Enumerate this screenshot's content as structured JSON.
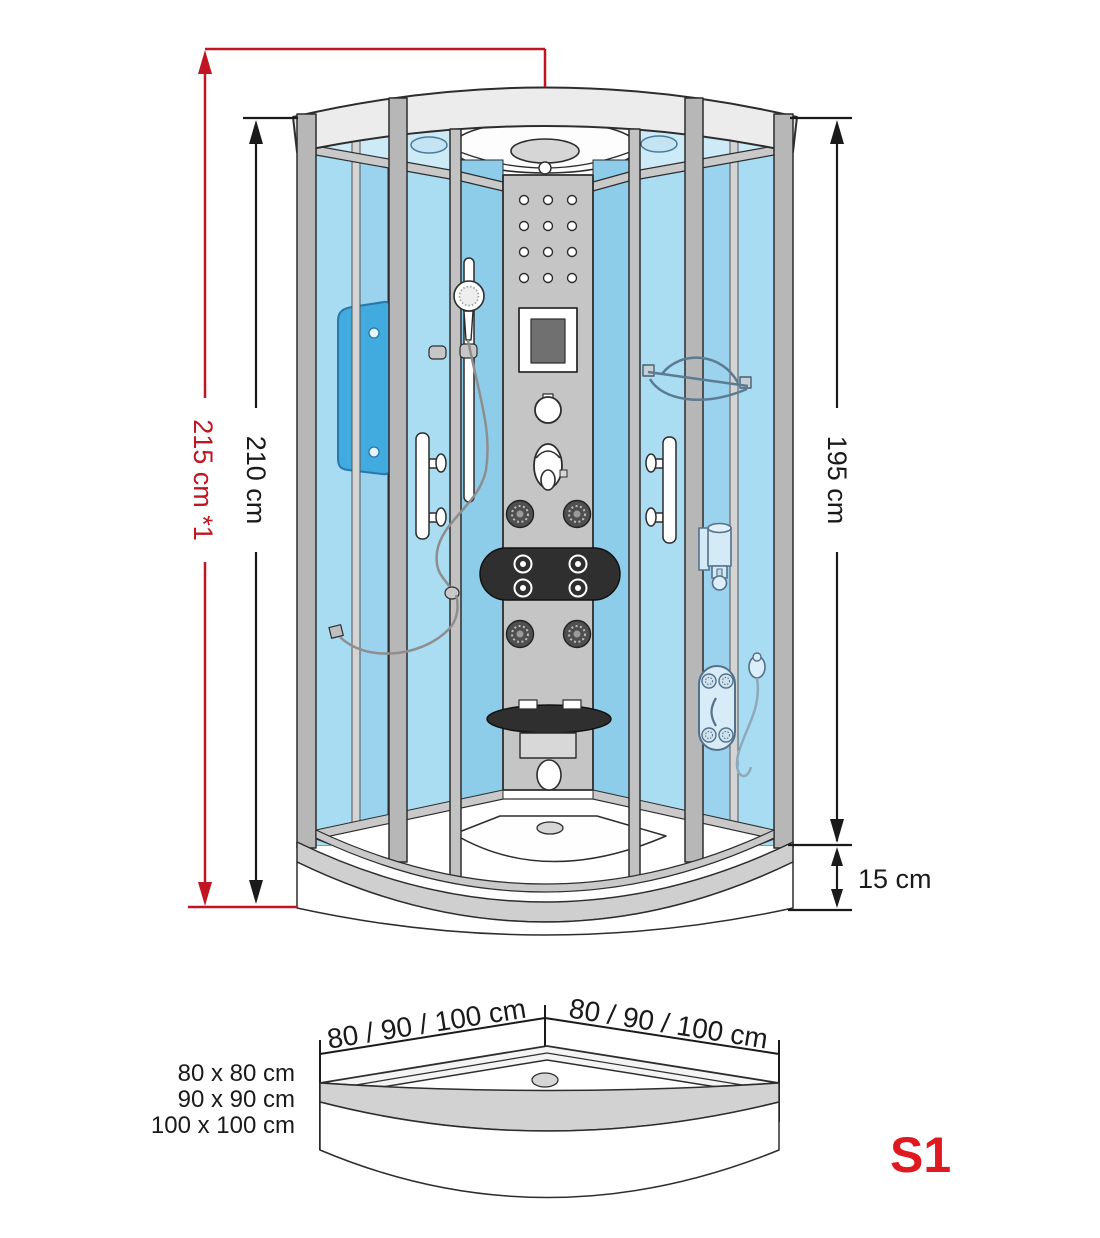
{
  "diagram": {
    "type": "shower-cabin-dimension-drawing",
    "heights": {
      "overall": "215 cm *1",
      "cabin": "210 cm",
      "interior": "195 cm",
      "tray": "15 cm"
    },
    "footprint": {
      "left_edge": "80 / 90 / 100 cm",
      "right_edge": "80 / 90 / 100 cm",
      "sizes": [
        "80 x 80 cm",
        "90 x 90 cm",
        "100 x 100 cm"
      ]
    },
    "model": "S1",
    "colors": {
      "dimension_red": "#bf1622",
      "model_red": "#e0181f",
      "line_black": "#1a1a1a",
      "glass_blue": "#9bd2ee",
      "glass_blue_light": "#cdeaf7",
      "accent_panel_blue": "#41aade",
      "frame_gray": "#b7b7b7",
      "panel_gray": "#c5c5c5",
      "dark_items": "#2f2f2f"
    }
  }
}
